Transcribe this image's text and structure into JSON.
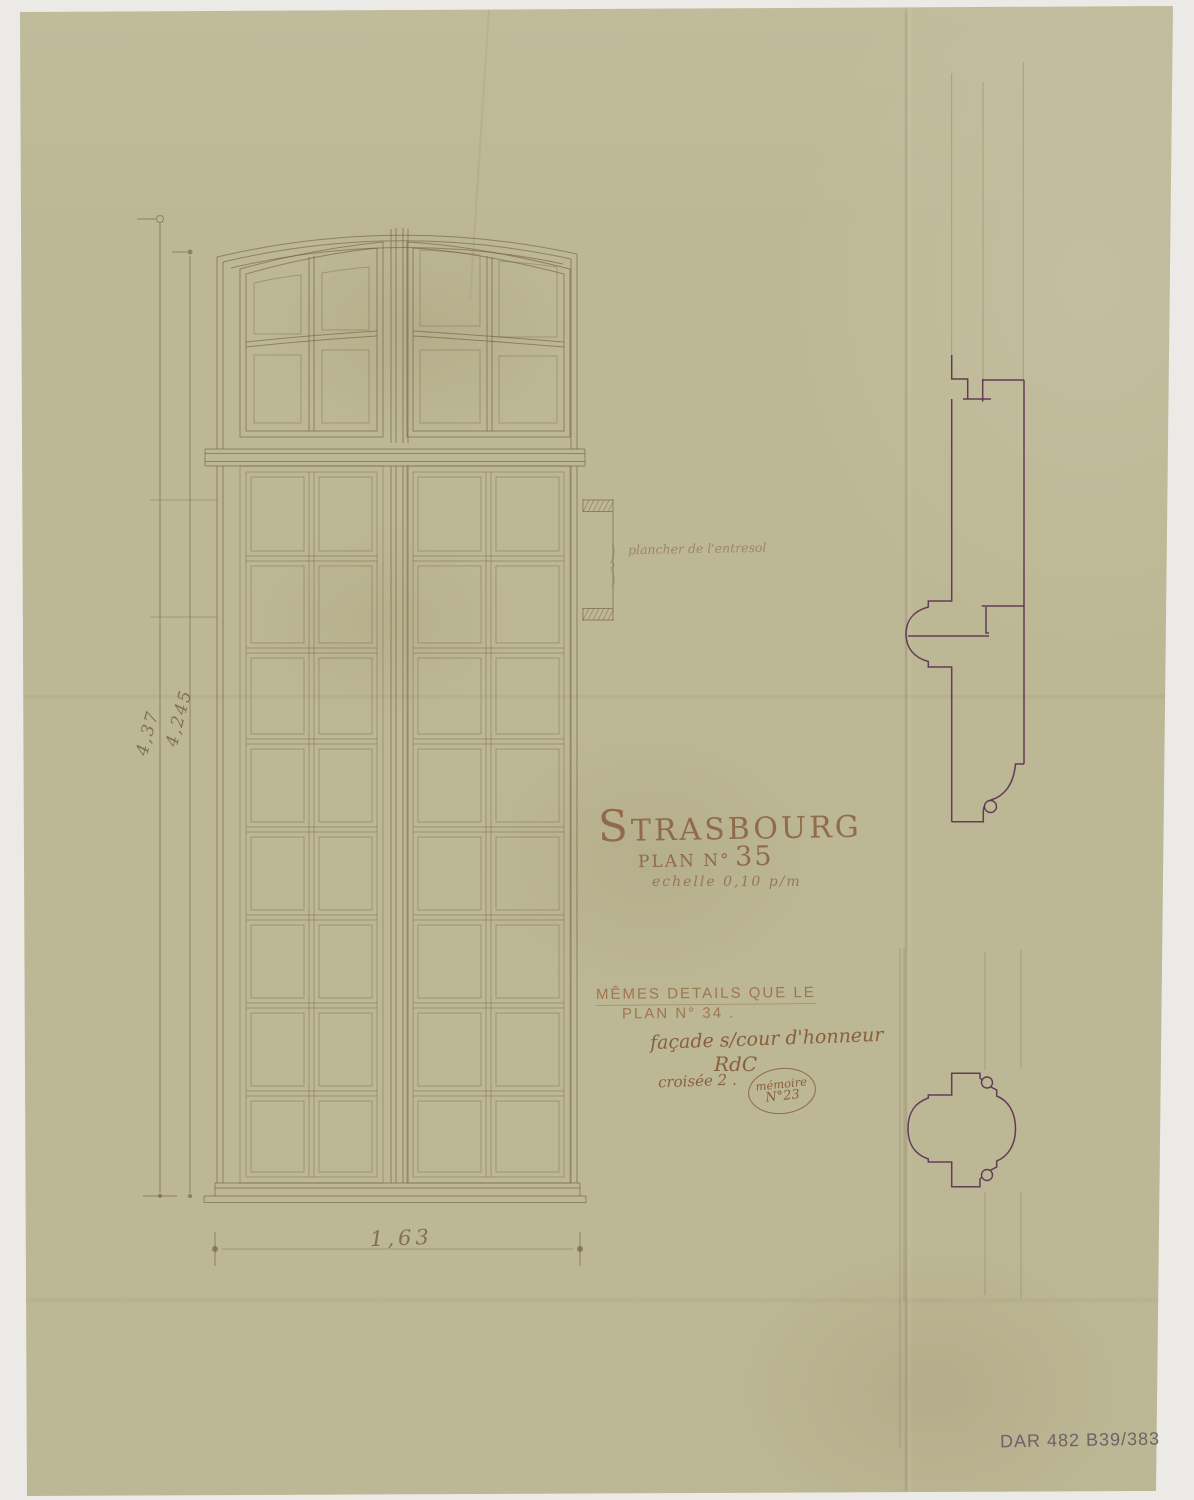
{
  "document": {
    "heading": "STRASBOURG",
    "plan_label": "PLAN N°",
    "plan_value": "35",
    "scale_note": "echelle 0,10 p/m",
    "archive_ref": "DAR 482 B39/383"
  },
  "notes": {
    "same_details_1": "MÊMES DETAILS QUE LE",
    "same_details_2": "PLAN N° 34 .",
    "facade": "façade s/cour d'honneur",
    "level": "RdC",
    "croisee": "croisée 2 .",
    "memoire_1": "mémoire",
    "memoire_2": "N°23"
  },
  "annotations": {
    "entresol": "plancher de l'entresol"
  },
  "dimensions": {
    "height_outer": "4,37",
    "height_inner": "4,245",
    "width_bottom": "1,63"
  },
  "colors": {
    "paper": "#bcb794",
    "ink_faint": "#6e5a3c",
    "ink_brown": "#8a5f3f",
    "ink_profile": "#5a2f4e",
    "pencil_gray": "#655a66"
  },
  "window_elevation": {
    "sashes": [
      {
        "x0": 240,
        "y0": 466,
        "x1": 383,
        "y1": 1183,
        "rows": [
          556,
          648,
          739,
          827,
          915,
          1003,
          1091
        ]
      },
      {
        "x0": 407,
        "y0": 466,
        "x1": 570,
        "y1": 1183,
        "rows": [
          556,
          648,
          739,
          827,
          915,
          1003,
          1091
        ]
      }
    ]
  }
}
